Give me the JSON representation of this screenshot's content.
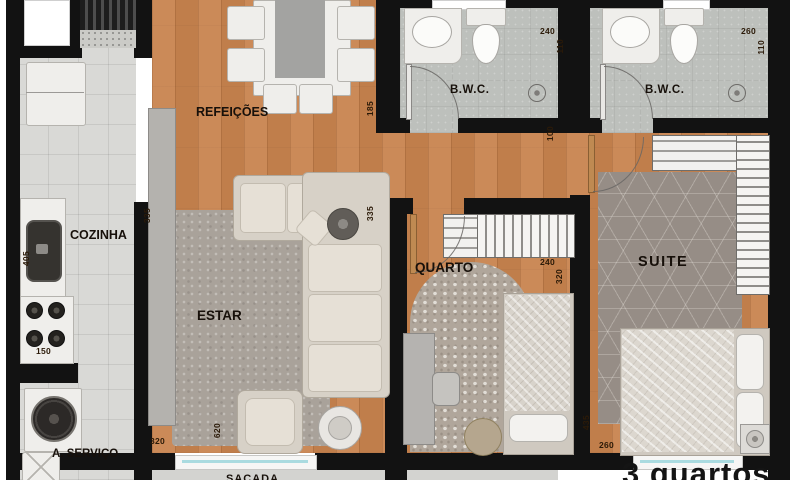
{
  "title": "3 quartos",
  "rooms": {
    "cozinha": "COZINHA",
    "refeicoes": "REFEIÇÕES",
    "estar": "ESTAR",
    "quarto": "QUARTO",
    "suite": "SUITE",
    "bwc1": "B.W.C.",
    "bwc2": "B.W.C.",
    "servico": "A. SERVIÇO",
    "sacada": "SACADA"
  },
  "dims": {
    "refeicoes_opening": "185",
    "estar_right": "335",
    "estar_left": "335",
    "hall": "100",
    "bwc1_w": "240",
    "bwc1_d": "110",
    "bwc2_w": "260",
    "bwc2_d": "110",
    "quarto_w": "240",
    "quarto_d": "320",
    "suite_d": "435",
    "suite_w": "260",
    "cozinha_d": "405",
    "cozinha_w": "150",
    "estar_w": "320",
    "estar_d": "620"
  },
  "colors": {
    "wood": "#c8834e",
    "wall": "#121212",
    "tile": "#d9d9d6",
    "bath": "#bdc0bc",
    "rug_estar": "#a9a29a",
    "rug_quarto": "#b0a69b",
    "rug_suite": "#968d86",
    "furniture_white": "#efeeeb",
    "furniture_beige": "#d7d1c7",
    "glass": "#aadbe0",
    "text": "#17100a"
  }
}
